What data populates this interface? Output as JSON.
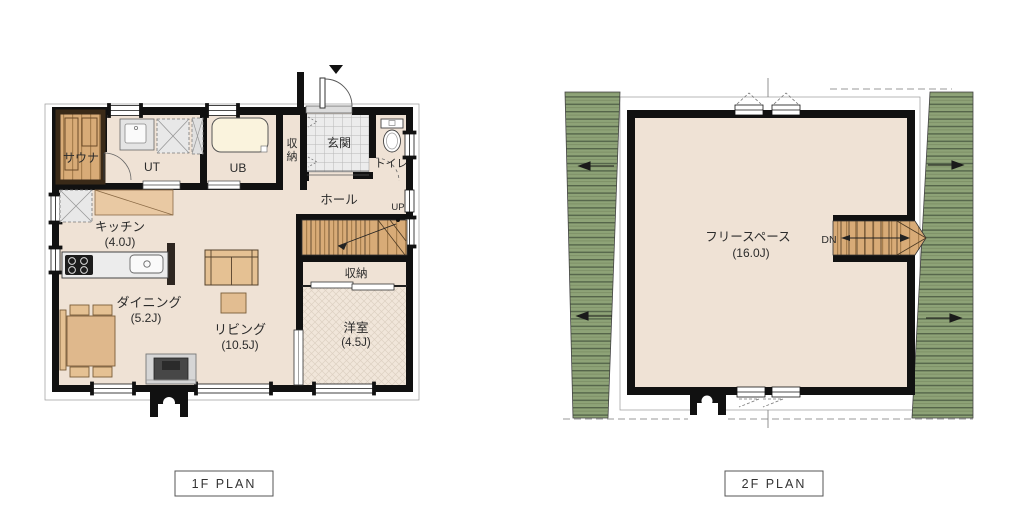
{
  "plans": {
    "first_floor": {
      "title": "1F PLAN",
      "rooms": {
        "sauna": {
          "label": "サウナ"
        },
        "utility": {
          "label": "UT"
        },
        "bath": {
          "label": "UB"
        },
        "entrance_storage": {
          "label": "収納"
        },
        "entrance": {
          "label": "玄関"
        },
        "toilet": {
          "label": "トイレ"
        },
        "hall": {
          "label": "ホール"
        },
        "stairs": {
          "label": "UP"
        },
        "kitchen": {
          "label": "キッチン",
          "size": "(4.0J)"
        },
        "dining": {
          "label": "ダイニング",
          "size": "(5.2J)"
        },
        "living": {
          "label": "リビング",
          "size": "(10.5J)"
        },
        "stair_storage": {
          "label": "収納"
        },
        "western_room": {
          "label": "洋室",
          "size": "(4.5J)"
        }
      }
    },
    "second_floor": {
      "title": "2F PLAN",
      "rooms": {
        "free_space": {
          "label": "フリースペース",
          "size": "(16.0J)"
        },
        "stairs": {
          "label": "DN"
        }
      }
    }
  },
  "colors": {
    "floor": "#efe2d5",
    "floor_hatch": "#f1e6da",
    "wood": "#d8ab77",
    "wall": "#111111",
    "roof_green": "#8ea377",
    "roof_line": "#55654a",
    "counter_gray": "#ececec",
    "tub_cream": "#faf3dd",
    "furniture_tan": "#e5c193",
    "tile_gray": "#ececec"
  }
}
